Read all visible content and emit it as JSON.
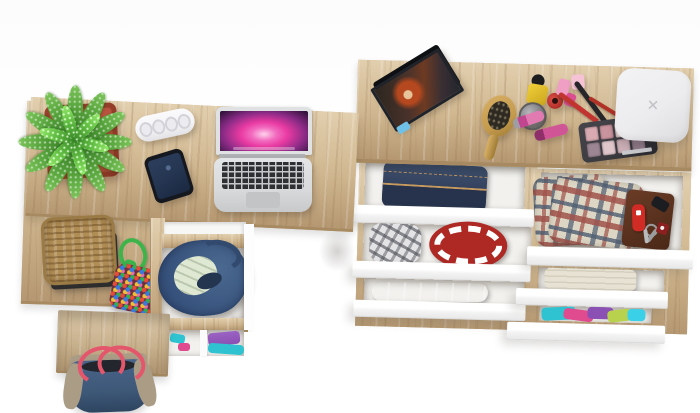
{
  "scene": {
    "type": "product-photo",
    "description": "Overhead view of a light oak corner desk with pedestal and open cupboard, beside a matching dresser with six staggered open white drawers, styled with everyday items",
    "background": "#ffffff"
  },
  "colors": {
    "wood": "#cfb68f",
    "woodLight": "#e2cfae",
    "woodDark": "#b59872",
    "woodEdge": "#a78a61",
    "drawerFront": "#fcfcfc",
    "interior": "#f2f1ee",
    "potRed": "#b5513d",
    "potRedDark": "#93402e",
    "leafGreen": "#55a23b",
    "leafGreenDark": "#2f7420",
    "stripWhite": "#f4f4f6",
    "phoneBody": "#15181e",
    "phoneScreen": "#253652",
    "laptopSilver": "#d7d9db",
    "keyboardKeys": "#2e3034",
    "wallpaperPink": "#e93aa2",
    "wallpaperPurple": "#64206e",
    "wallpaperDark": "#23102f",
    "basketTan": "#b08d55",
    "trayBlack": "#2b2b2d",
    "ropeGreen": "#3cb44a",
    "pouchBase": "#6b3040",
    "denimBag": "#4a6890",
    "denimBagDark": "#35507a",
    "bagCloth": "#dfe8d2",
    "clothPurple": "#8a50b4",
    "clothTeal": "#2fc3d2",
    "clothMagenta": "#e04a8e",
    "clothLime": "#b9d24e",
    "toteDenim": "#3e5878",
    "toteTan": "#ab9c86",
    "toteStrap": "#e4566c",
    "jeans": "#2e3c58",
    "jeansLight": "#41516e",
    "stitch": "#c79a5f",
    "capGray": "#9b9da0",
    "redHat": "#ae2824",
    "pantsGray": "#9aa0a5",
    "shirtPlaidRed": "#a0524a",
    "shirtPlaidBlue": "#4e5d72",
    "shirtPlaidCream": "#ddd6c4",
    "walletBrown": "#552f1e",
    "knifeRed": "#d02b24",
    "metalGray": "#9a9c9e",
    "towel": "#e7e2d3",
    "frameDark": "#20242a",
    "photoHair": "#b5481e",
    "photoBg": "#3a2f28",
    "photoBlue": "#6fc1e8",
    "brushWood": "#c59b4e",
    "bristleDark": "#2e2a22",
    "polishYellow": "#e8c22e",
    "jarSilver": "#8d8d91",
    "polishRed": "#c03028",
    "lipstickPink": "#e27ab2",
    "lipstickDeep": "#c2458f",
    "paletteCase": "#3a3a3f",
    "boxWhite": "#ececee",
    "boxMark": "#c2c2c6"
  },
  "dresser": {
    "name": "dresser with six open drawers",
    "top_items": [
      {
        "name": "photo-frame",
        "subject": "portrait with red hair"
      },
      {
        "name": "hairbrush"
      },
      {
        "name": "cosmetics",
        "pieces": [
          "yellow nail polish",
          "silver cream jar",
          "red nail polish",
          "pink perfume bottles",
          "two lipsticks",
          "makeup brushes",
          "red pencil"
        ]
      },
      {
        "name": "eyeshadow-palette"
      },
      {
        "name": "white-storage-box",
        "mark": "✕"
      }
    ],
    "palette_pans": [
      "#d9aab2",
      "#c9949e",
      "#ecd8da",
      "#b292a0",
      "#9d8694",
      "#dfc6cb",
      "#cdb0b8",
      "#8f7a88"
    ],
    "left_drawers": [
      {
        "contents": "folded dark jeans"
      },
      {
        "contents": "gray plaid cap and red patterned hat"
      },
      {
        "contents": "gray folded trousers"
      }
    ],
    "right_drawers": [
      {
        "contents": "plaid shirts, leather wallet, pocket knife, keys"
      },
      {
        "contents": "beige towel"
      },
      {
        "contents": "colorful folded clothes"
      }
    ]
  },
  "desk": {
    "name": "corner desk with pedestal and open cupboard",
    "top_items": [
      {
        "name": "potted-plant"
      },
      {
        "name": "power-strip"
      },
      {
        "name": "smartphone"
      },
      {
        "name": "laptop",
        "wallpaper": "pink aurora"
      },
      {
        "name": "wicker-basket on black tray"
      },
      {
        "name": "bead-pouch with green cord"
      }
    ],
    "cupboard_items": [
      {
        "name": "denim storage bag with pale clothes"
      },
      {
        "name": "purple and teal folded clothes"
      }
    ],
    "floor_items": [
      {
        "name": "denim tote bag with red straps"
      }
    ]
  }
}
